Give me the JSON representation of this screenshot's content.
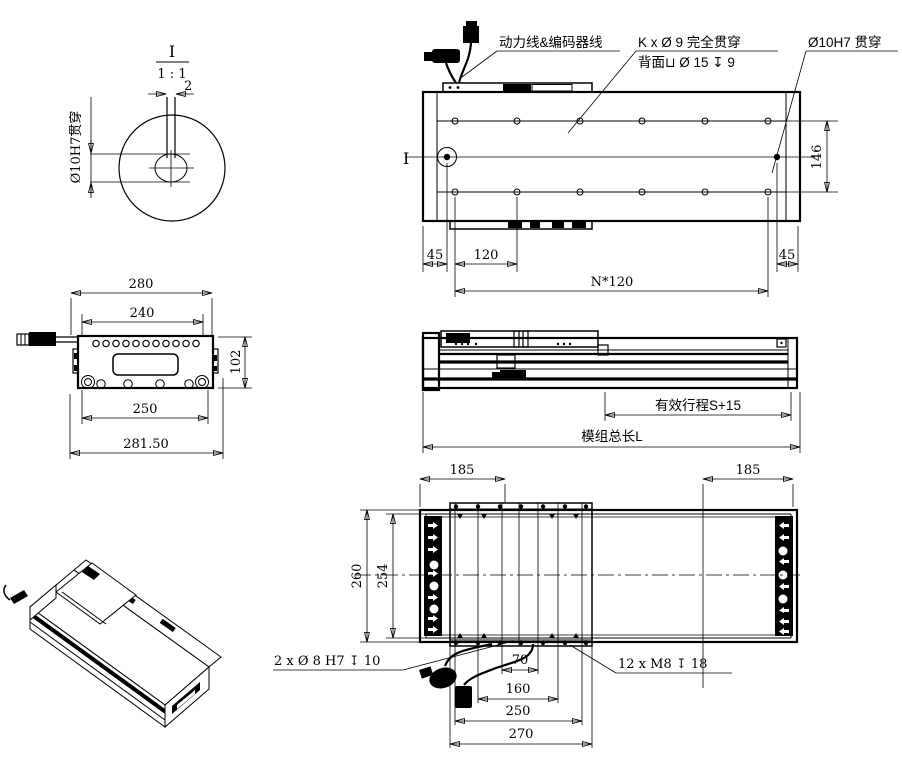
{
  "drawing": {
    "background": "#ffffff",
    "line_color": "#000000",
    "type": "linear-motion-module engineering drawing, 5 views"
  },
  "detail_view": {
    "title": "I",
    "scale": "1 : 1",
    "slot_width_dim": "2",
    "hole_label": "Ø10H7贯穿"
  },
  "top_view": {
    "section_marker": "I",
    "cable_label": "动力线&编码器线",
    "hole_callout_line1": "K x Ø 9 完全贯穿",
    "hole_callout_line2": "背面⊔ Ø 15 ↧ 9",
    "dowel_callout": "Ø10H7 贯穿",
    "dim_left_margin": "45",
    "dim_pitch": "120",
    "dim_total_pitch": "N*120",
    "dim_right_margin": "45",
    "dim_hole_row_span": "146"
  },
  "end_view": {
    "dim_body_width": "280",
    "dim_top_hole_span": "240",
    "dim_height": "102",
    "dim_bottom_span": "250",
    "dim_total_width": "281.50"
  },
  "side_view": {
    "stroke_label": "有效行程S+15",
    "total_length_label": "模组总长L"
  },
  "bottom_view": {
    "dim_left_offset": "185",
    "dim_right_offset": "185",
    "dim_outer_width": "260",
    "dim_inner_width": "254",
    "dim_hole_pitch_small": "70",
    "dim_hole_pitch_mid": "160",
    "dim_hole_pitch_large": "250",
    "dim_carriage_length": "270",
    "dowel_callout": "2 x Ø 8 H7 ↧ 10",
    "thread_callout": "12 x M8 ↧ 18"
  }
}
